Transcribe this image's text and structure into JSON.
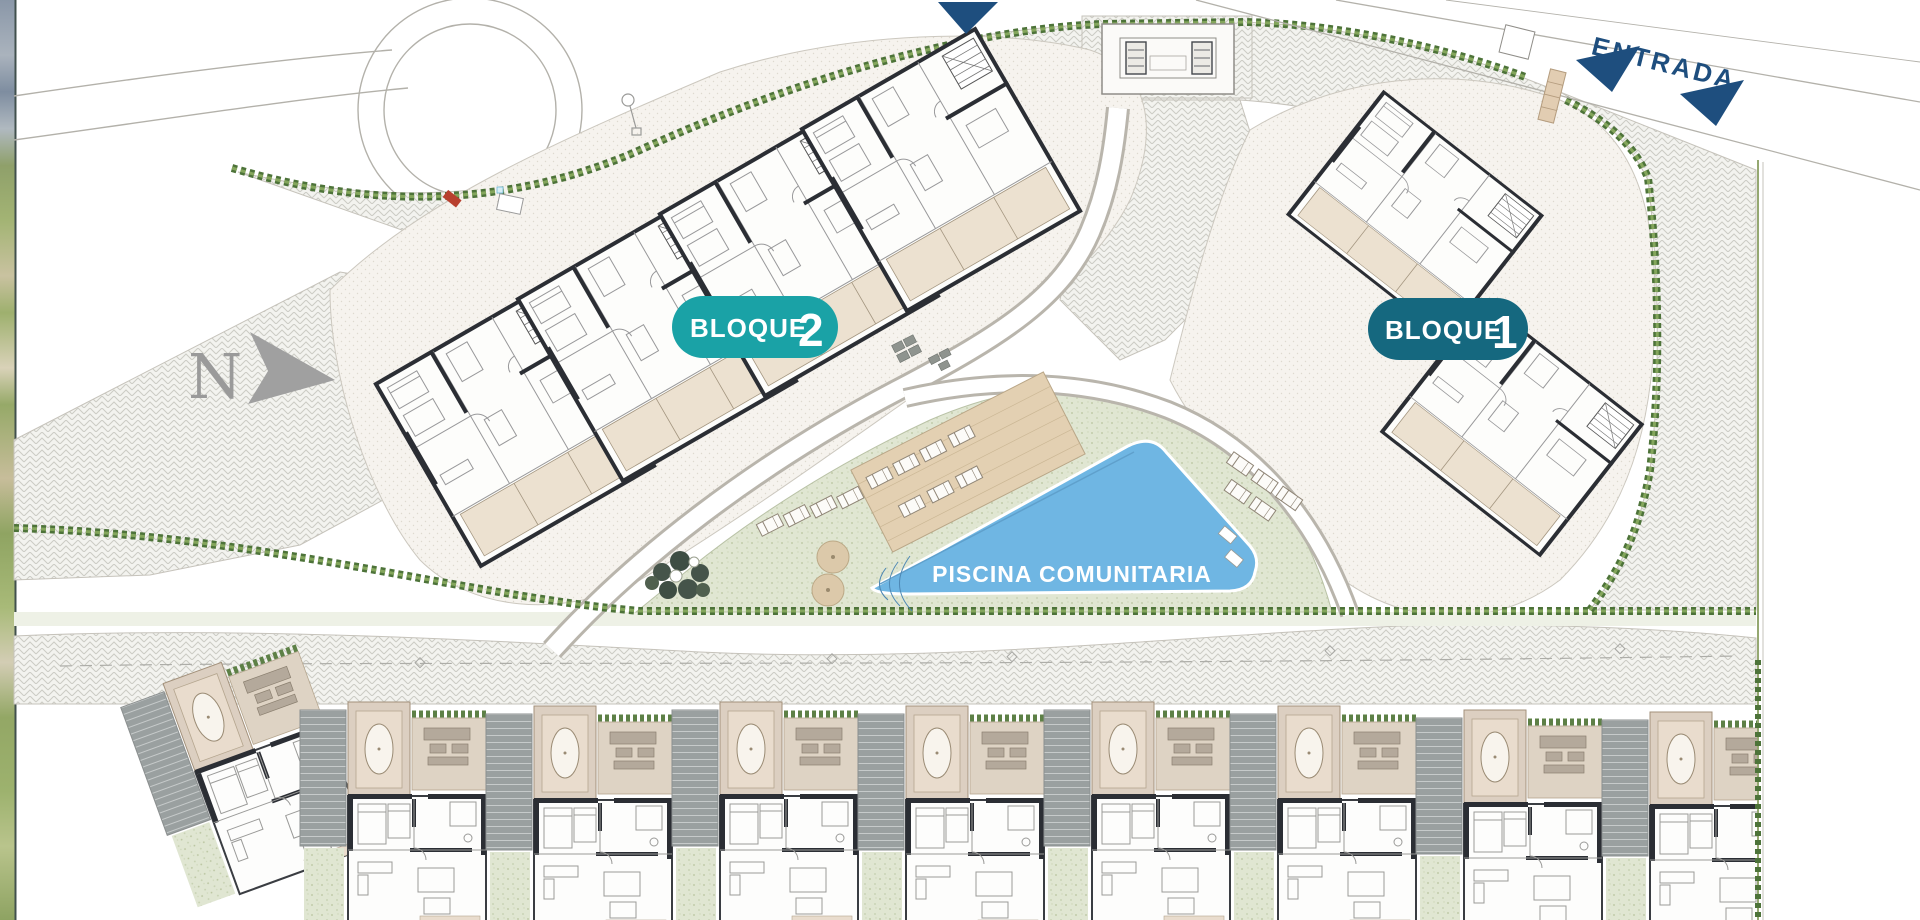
{
  "plan": {
    "north_label": "N",
    "entrance_label": "ENTRADA",
    "pool_label": "PISCINA COMUNITARIA",
    "block1": {
      "label": "BLOQUE",
      "number": "1"
    },
    "block2": {
      "label": "BLOQUE",
      "number": "2"
    },
    "townhouse_units_visible": 9,
    "apartment_modules_block2": 4,
    "apartment_wings_block1": 2,
    "colors": {
      "block2_badge": "#1aa2a6",
      "block1_badge": "#15687f",
      "pool_water": "#6fb6e3",
      "entrance_navy": "#1e4e7e",
      "lawn_green": "#dfe5d2",
      "hedge_green": "#5d8046",
      "terrace_beige": "#e9ddca",
      "paving_gray": "#f3f3ef",
      "wall_black": "#2b2e34",
      "north_arrow_gray": "#a0a0a0"
    }
  }
}
